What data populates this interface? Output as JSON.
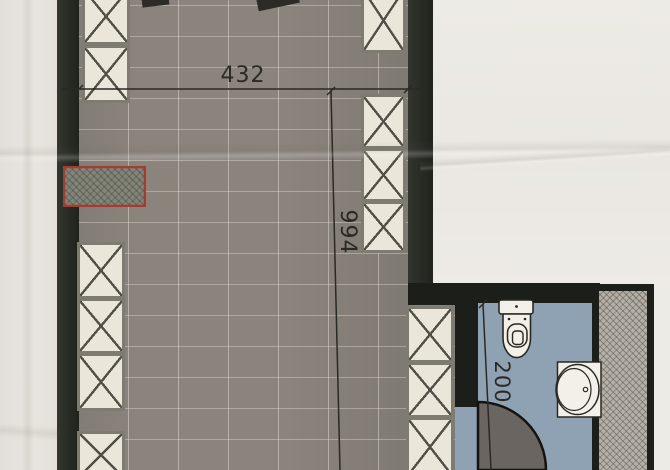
{
  "plan": {
    "dim_width": "432",
    "dim_height": "994",
    "dim_bath": "200"
  },
  "colors": {
    "paper": "#e8e5e0",
    "paper-bright": "#edebe6",
    "wall": "#262b23",
    "floor": "#8a847d",
    "box-fill": "#eae6da",
    "box-border": "#7e7b71",
    "x-line": "#514f46",
    "red": "#a63b30",
    "bath-floor": "#8fa2b3",
    "bath-wall": "#1b1e19",
    "hatch-fill": "#b4b0a8",
    "door": "#6a6560",
    "fixture": "#f2f0e9",
    "fixture-line": "#2a2823",
    "dim": "#2b2924"
  }
}
